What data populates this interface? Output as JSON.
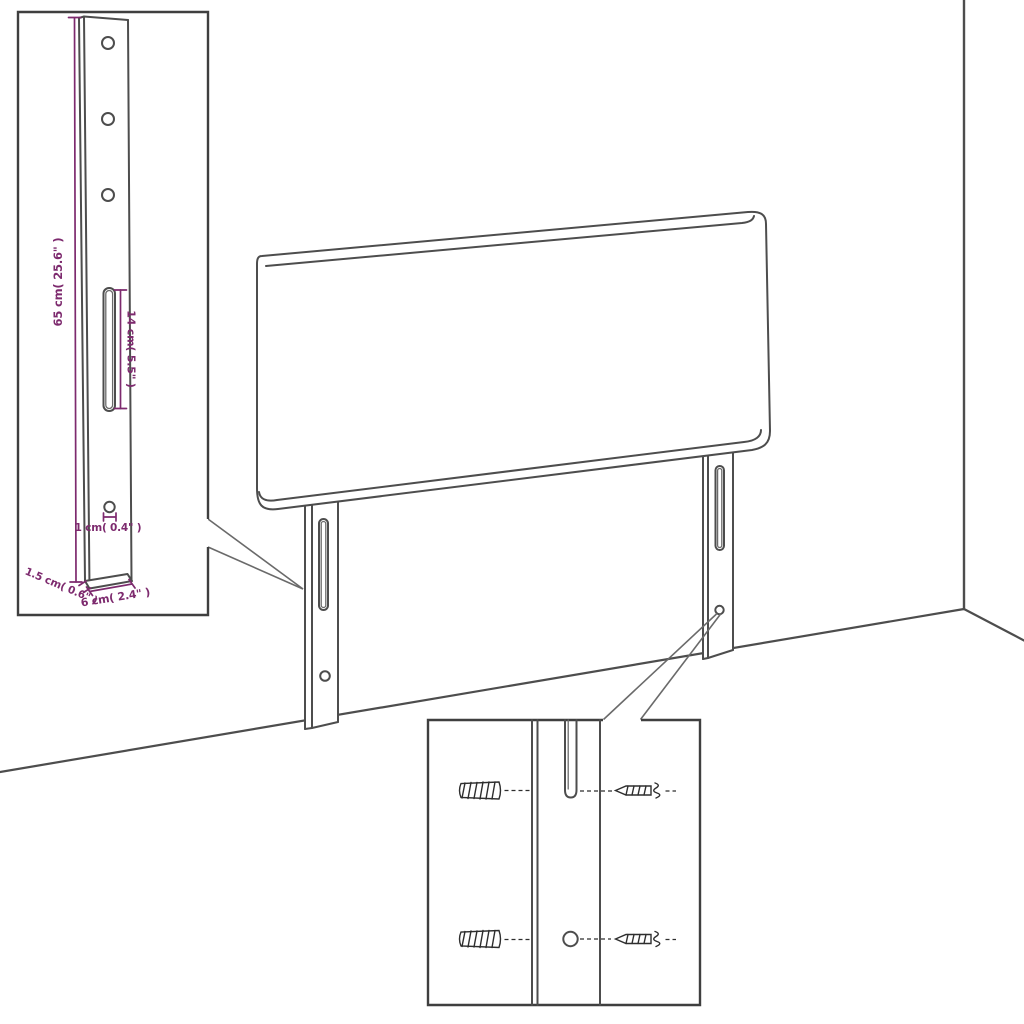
{
  "diagram": {
    "type": "furniture-assembly-dimension-diagram",
    "subject": "upholstered headboard with two slotted mounting legs, shown against a room wall corner",
    "colors": {
      "background": "#ffffff",
      "line": "#4d4d4d",
      "dimension": "#7d2a6e",
      "hardware": "#2e2e2e"
    },
    "leg_detail_inset": {
      "labels": {
        "total_height": "65 cm( 25.6\" )",
        "slot_length": "14 cm( 5.5\" )",
        "hole_diameter": "1 cm( 0.4\" )",
        "thickness": "1.5 cm( 0.6\" )",
        "width": "6 cm( 2.4\" )"
      },
      "features": [
        "three-screw-holes",
        "long-slot",
        "lower-hole"
      ]
    },
    "mounting_detail_inset": {
      "hardware": [
        "wall-plug",
        "screw"
      ],
      "rows": 2
    }
  }
}
